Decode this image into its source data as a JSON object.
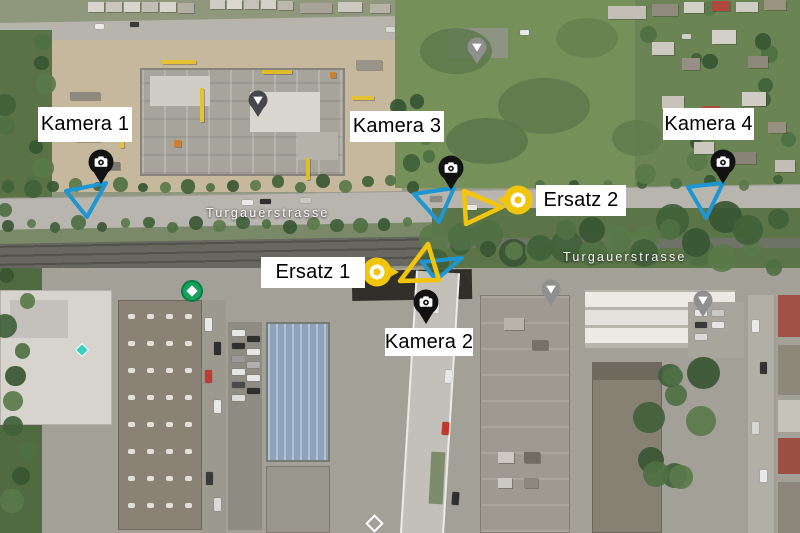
{
  "map": {
    "type": "satellite-aerial-view",
    "street_labels": [
      "Turgauerstrasse",
      "Turgauerstrasse"
    ]
  },
  "annotations": {
    "cameras": [
      {
        "label": "Kamera 1",
        "fov": "blue-triangle"
      },
      {
        "label": "Kamera 2",
        "fov": "blue-and-yellow-triangles"
      },
      {
        "label": "Kamera 3",
        "fov": "blue-and-yellow-triangles"
      },
      {
        "label": "Kamera 4",
        "fov": "blue-triangle"
      }
    ],
    "ersatz_markers": [
      {
        "label": "Ersatz 1",
        "shape": "yellow-teardrop-right"
      },
      {
        "label": "Ersatz 2",
        "shape": "yellow-teardrop-left"
      }
    ],
    "colors": {
      "fov_blue": "#1e96d2",
      "ersatz_yellow": "#f2c50a",
      "camera_pin": "#121212",
      "label_background": "#ffffff",
      "label_text": "#000000",
      "street_label_text": "#ffffff",
      "transit_marker_green": "#14a25c"
    },
    "icons": {
      "camera_pin": "camera-icon",
      "street_view_marker": "photosphere-drop-icon",
      "transit_marker": "green-arrow-circle-icon",
      "poi_marker": "teal-diamond-icon",
      "junction_marker": "white-diamond-icon"
    }
  }
}
